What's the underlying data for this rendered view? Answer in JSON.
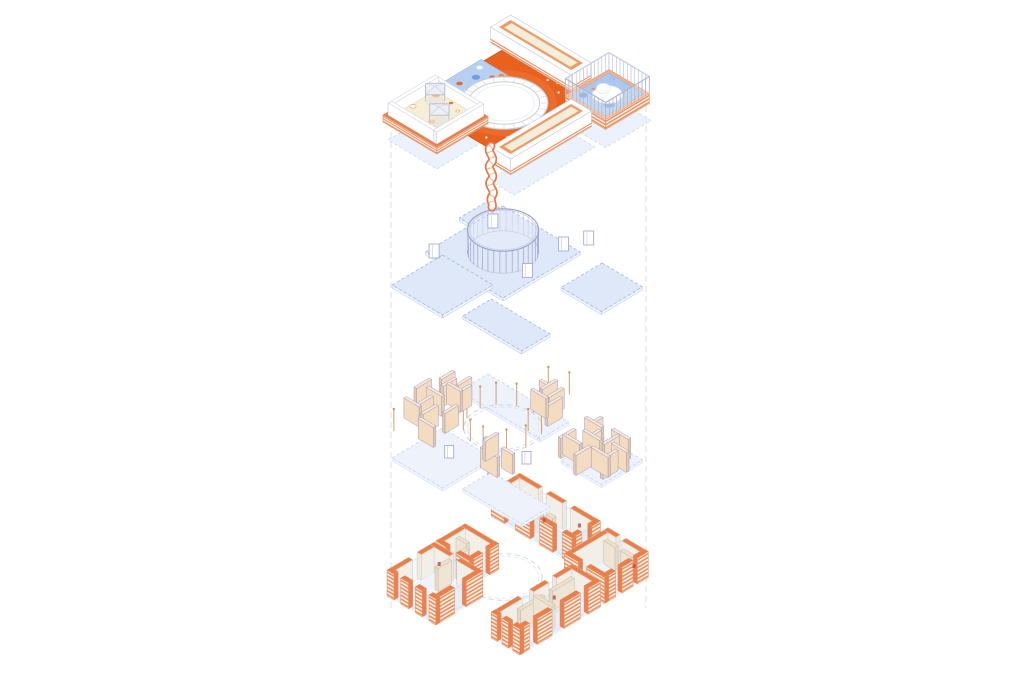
{
  "diagram": {
    "kind": "exploded-axonometric-building-diagram",
    "background": "#ffffff",
    "levels": [
      {
        "id": "roof-plan"
      },
      {
        "id": "floor-plates-colonnade"
      },
      {
        "id": "partition-panels"
      },
      {
        "id": "brick-walls"
      }
    ],
    "palette": {
      "deckOrange": "#e8611f",
      "deckGlow": "#f07b3a",
      "deckStroke": "#c9511a",
      "stripeOrange": "#ef8c5a",
      "brickFace": "#fdf2ea",
      "brickTop": "#ec7e47",
      "brickEnd": "#ea8150",
      "brickStroke": "#d8936c",
      "rimFrame": "#ef9a64",
      "cream": "#f2eedb",
      "creamStroke": "#e8b285",
      "creamFloor": "#f7eed6",
      "creamFloorStroke": "#e3d9bd",
      "poolBlue": "#abc9ef",
      "poolStroke": "#9fb4dd",
      "splashBlue": "#b7d0f1",
      "blueMid": "#6d98e0",
      "blueDark": "#5d86d4",
      "blueSoft": "#9cbcf0",
      "plateFill": "#dfe8f8",
      "plateSide": "#f0f5fd",
      "plateStroke": "#9fb4dd",
      "plateFillFaint": "#edf2fb",
      "plateStrokeFaint": "#c6d3ee",
      "shadowFill": "#e6edf9",
      "shadowStroke": "#c9d7f0",
      "tanFace": "#f3dcc0",
      "tanEnd": "#e9cba9",
      "tanTop": "#f9ead6",
      "tanStroke": "#a09ac8",
      "tanInFace": "#efe5d6",
      "tanInEnd": "#e7d9c4",
      "tanInTop": "#f0e0cb",
      "tanInStroke": "#c4bba8",
      "post": "#d8a87c",
      "postCap": "#c89468",
      "innerFace": "#f2efe8",
      "innerEnd": "#efe9df",
      "innerStroke": "#cfc8bc",
      "line": "#9aa3cc",
      "lineSoft": "#c3c9e2",
      "gray": "#c5c9d6",
      "grayFill": "#f3f4f8",
      "ringStroke": "#c2c7d6",
      "ringTick": "#d9dde9",
      "white": "#ffffff",
      "glaze": "#dce8f8",
      "glazeStroke": "#b9c8e4",
      "guide": "#dcdcdc",
      "canopy": "#edeff5",
      "canopyStroke": "#b6bcd2",
      "beak": "#f08c3f",
      "orangeBlob": "#f4a869",
      "orangeBlobDeep": "#e8681f",
      "peach": "#f6c693",
      "peachDot": "#f7bd94",
      "floorFill": "#f1f5fb",
      "floorStroke": "#d9dfec",
      "red": "#c0504d",
      "rampEdge": "#e8774a",
      "rampRib": "#f0a070",
      "poolRim": "#f4b088"
    }
  }
}
